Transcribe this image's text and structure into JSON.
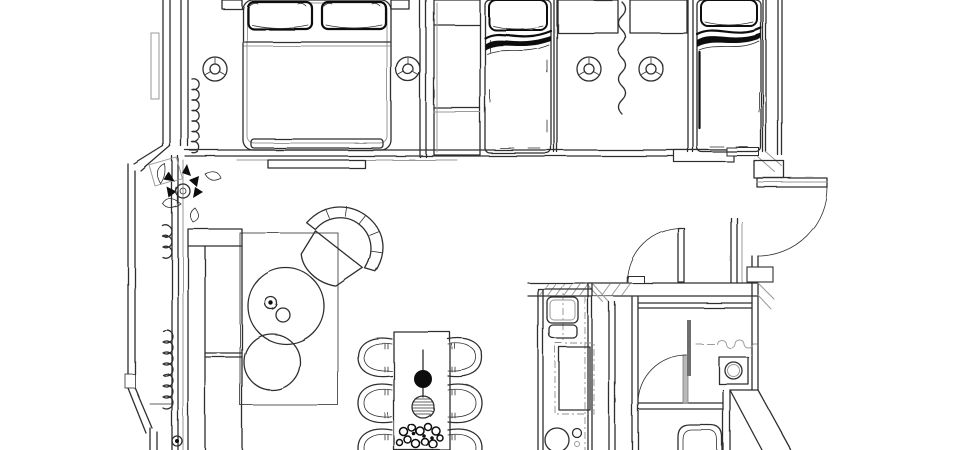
{
  "drawing": {
    "kind": "architectural floor plan",
    "view": "top-down line drawing with slight 3D wall projection",
    "palette": {
      "background": "#ffffff",
      "ink": "#2f2f2f",
      "light_ink": "#9a9a9a",
      "dark_fill": "#101010"
    },
    "ceiling_lights_count": 4
  },
  "fixtures": {
    "bedroom_main": [
      "double-bed",
      "pillow",
      "pillow",
      "bedside-shelf",
      "bedside-shelf",
      "foot-bench",
      "wardrobe",
      "window-curtain",
      "ceiling-light",
      "ceiling-light"
    ],
    "bedroom_second": [
      "single-bed",
      "single-bed",
      "floor-mat",
      "floor-mat",
      "curtain-divider",
      "ceiling-light",
      "ceiling-light"
    ],
    "living_room": [
      "sofa",
      "rug",
      "coffee-table-large",
      "coffee-table-small",
      "cup",
      "cup",
      "armchair",
      "tv-console",
      "curtain",
      "curtain",
      "plant",
      "side-table",
      "knob"
    ],
    "dining_area": [
      "dining-table",
      "dining-chair",
      "dining-chair",
      "dining-chair",
      "dining-chair",
      "dining-chair",
      "dining-chair",
      "vase",
      "pendant-ball",
      "flower-bouquet"
    ],
    "kitchen": [
      "counter",
      "cooktop",
      "oven",
      "sink",
      "faucet"
    ],
    "bathroom": [
      "door",
      "shower-rail",
      "shower-curtain",
      "washing-machine",
      "bathtub"
    ],
    "circulation": [
      "entry-door",
      "threshold",
      "interior-door",
      "sliding-door-ledge"
    ]
  }
}
